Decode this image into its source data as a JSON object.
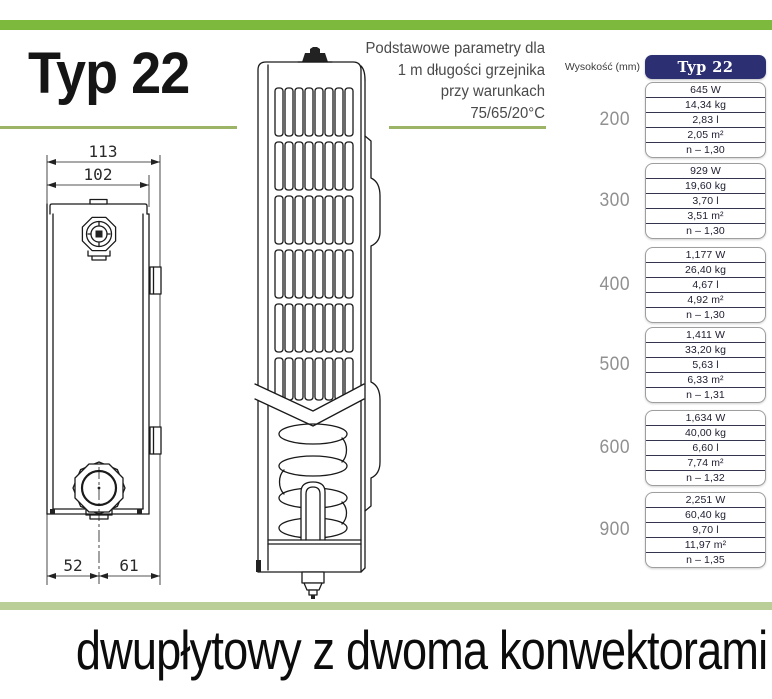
{
  "header": {
    "title": "Typ 22",
    "note_lines": [
      "Podstawowe parametry dla",
      "1 m długości grzejnika",
      "przy warunkach",
      "75/65/20°C"
    ]
  },
  "drawing": {
    "dim_total": "113",
    "dim_inner": "102",
    "dim_bottom_left": "52",
    "dim_bottom_right": "61"
  },
  "table": {
    "heading": "Wysokość (mm)",
    "type_label": "Typ 22",
    "groups": [
      {
        "height": "200",
        "values": [
          "645 W",
          "14,34 kg",
          "2,83 l",
          "2,05 m²",
          "n – 1,30"
        ]
      },
      {
        "height": "300",
        "values": [
          "929 W",
          "19,60 kg",
          "3,70 l",
          "3,51 m²",
          "n – 1,30"
        ]
      },
      {
        "height": "400",
        "values": [
          "1,177 W",
          "26,40 kg",
          "4,67 l",
          "4,92 m²",
          "n – 1,30"
        ]
      },
      {
        "height": "500",
        "values": [
          "1,411 W",
          "33,20 kg",
          "5,63 l",
          "6,33 m²",
          "n – 1,31"
        ]
      },
      {
        "height": "600",
        "values": [
          "1,634 W",
          "40,00 kg",
          "6,60 l",
          "7,74 m²",
          "n – 1,32"
        ]
      },
      {
        "height": "900",
        "values": [
          "2,251 W",
          "60,40 kg",
          "9,70 l",
          "11,97 m²",
          "n – 1,35"
        ]
      }
    ]
  },
  "footer": {
    "caption": "dwupłytowy z dwoma konwektorami"
  },
  "colors": {
    "accent_green": "#7cb93d",
    "olive_green": "#9cb465",
    "sage_green": "#b9cf97",
    "navy": "#2d2f73",
    "height_grey": "#909090"
  }
}
